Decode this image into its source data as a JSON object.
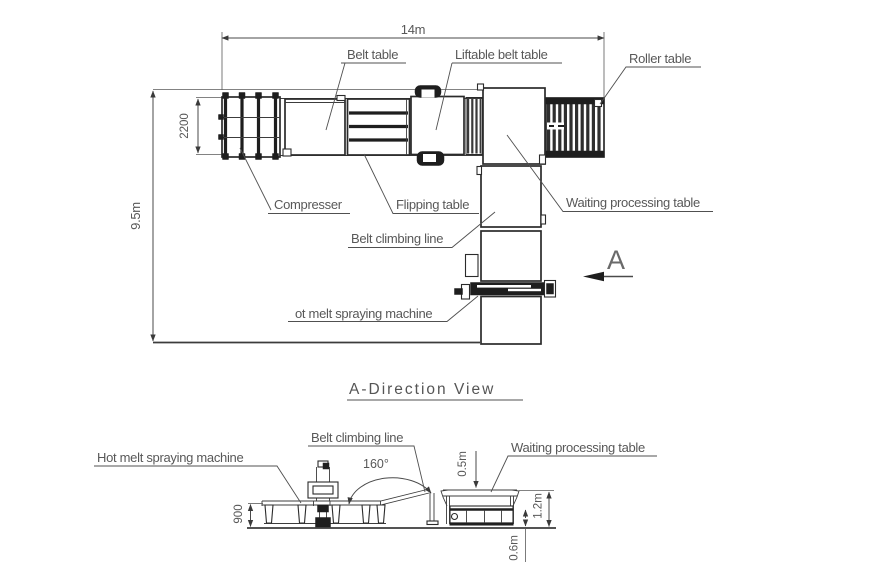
{
  "colors": {
    "background": "#ffffff",
    "drawing_line": "#2b2b2b",
    "text": "#585858",
    "dark_fill": "#1e1e1e"
  },
  "top_view": {
    "dim_width": "14m",
    "dim_height": "9.5m",
    "dim_compressor_height": "2200",
    "direction_marker": "A",
    "labels": {
      "belt_table": "Belt table",
      "liftable_belt_table": "Liftable belt table",
      "roller_table": "Roller table",
      "compresser": "Compresser",
      "flipping_table": "Flipping table",
      "waiting_processing_table": "Waiting processing table",
      "belt_climbing_line": "Belt climbing line",
      "hot_melt_spraying_machine": "ot melt spraying machine"
    }
  },
  "section_view": {
    "title": "A-Direction View",
    "labels": {
      "hot_melt_spraying_machine": "Hot melt spraying machine",
      "belt_climbing_line": "Belt climbing line",
      "waiting_processing_table": "Waiting processing table"
    },
    "dims": {
      "angle": "160°",
      "height_900": "900",
      "drop_05": "0.5m",
      "total_12": "1.2m",
      "lower_06": "0.6m"
    }
  }
}
